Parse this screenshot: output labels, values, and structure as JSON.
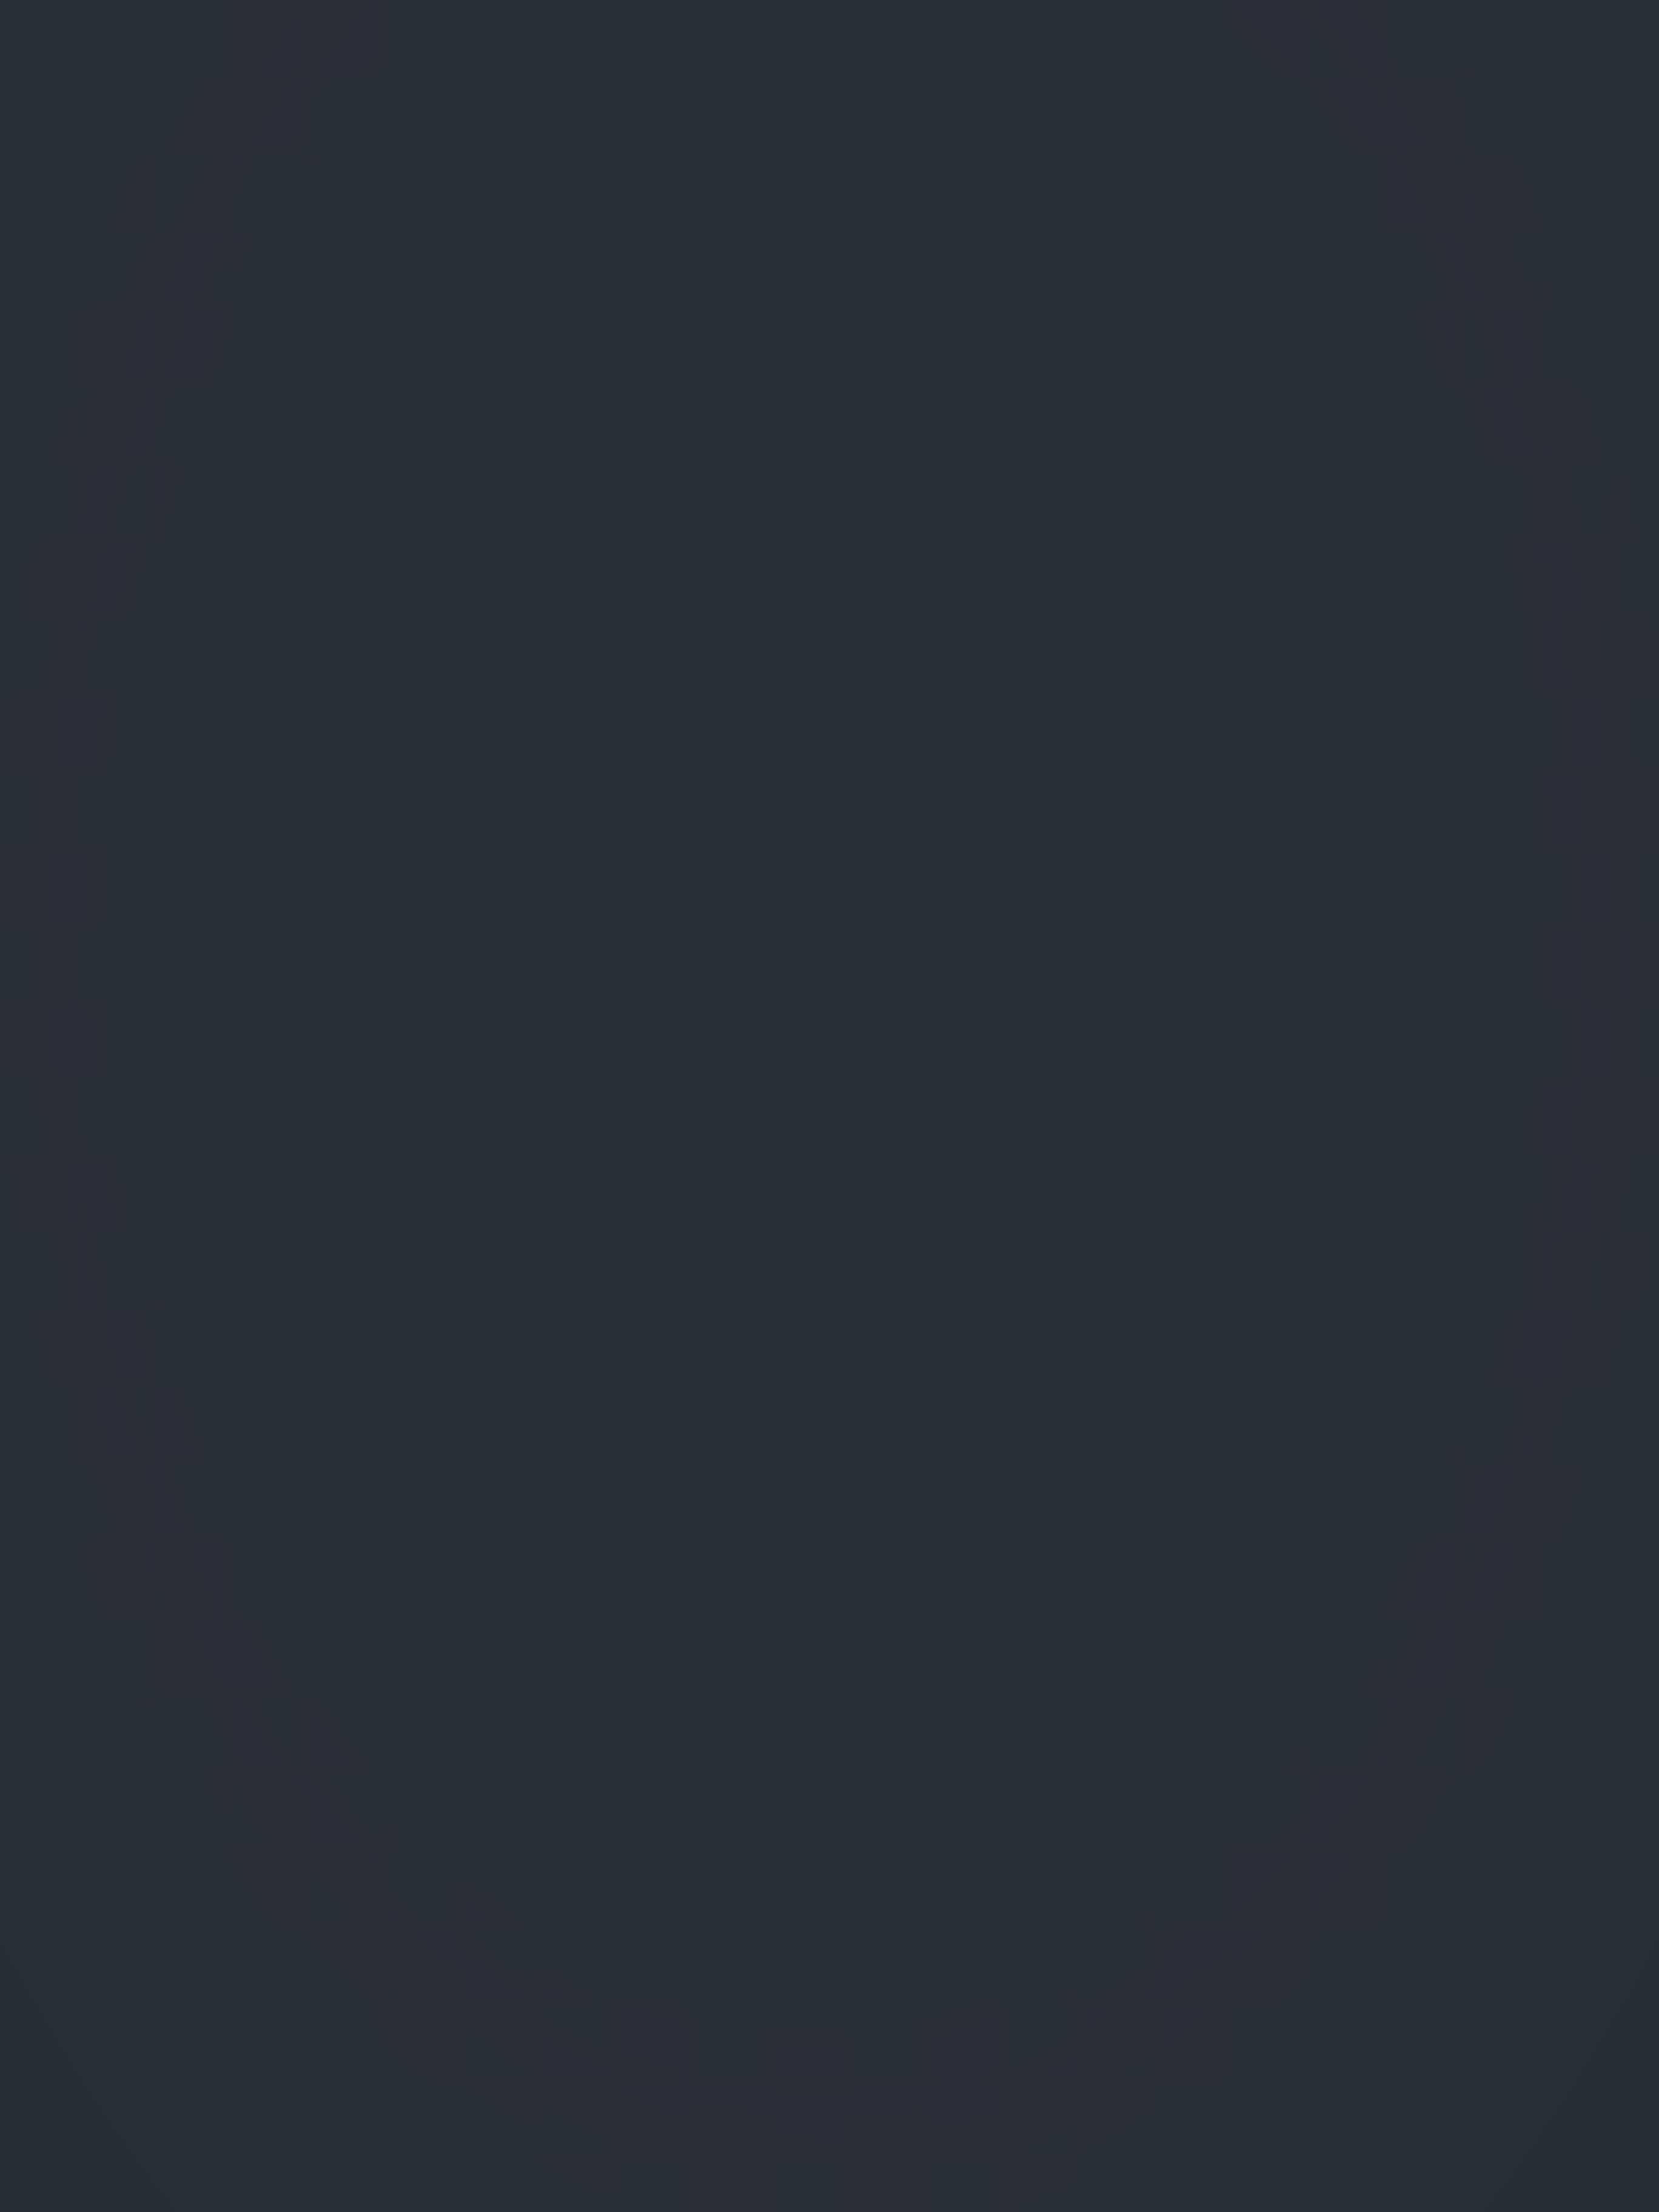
{
  "title": "宗 地 图",
  "unit_note": "单位: m.m²",
  "header": {
    "parcel_code_label": "宗地代码:",
    "parcel_code": "430281105212JC00010",
    "rights_holder_label": "土地权利人:",
    "rights_holder": "唐征",
    "sheet_no_label": "所在图幅号:",
    "sheet_no": "3068.00-458.50",
    "parcel_area_label": "宗地面积:",
    "parcel_area": "96.42"
  },
  "map": {
    "north_label": "北",
    "field_symbol": "↓",
    "building_top": "砖2",
    "building_right": "砖3",
    "building_bottom": "砖3",
    "cement": "水泥",
    "village": "王仙镇司徒村新屋组",
    "parcel": {
      "owner": "唐征",
      "code": "JC00010",
      "subcode": "072",
      "area": "96.42",
      "points": [
        {
          "name": "J1"
        },
        {
          "name": "J2"
        },
        {
          "name": "J3"
        },
        {
          "name": "J4"
        }
      ],
      "dim_top": "20.35",
      "dim_bottom": "20.30",
      "dim_left": "4.75",
      "dim_right": "4.75"
    },
    "road_markers": [
      "95",
      "94",
      "93",
      "92",
      "91",
      "90"
    ]
  },
  "stamp": {
    "line1": "醴陵市国土资源测绘院",
    "line2": "成果资料专用章",
    "grade_label": "证书等级:",
    "grade": "乙 级",
    "certno_label": "证书编号:",
    "certno": "4311522",
    "issuer_label": "发证机关:",
    "issuer": "湖南省国土资源厅"
  },
  "side_label": "醴陵市国土资源局",
  "footer": {
    "survey_note": "2017年解析法测绘界址点",
    "draw_date_label": "制图日期:",
    "draw_date": "2017年8月19日",
    "review_date_label": "审核日期:",
    "review_date": "2017年8月19日",
    "scale": "1:300",
    "drafter_label": "制图者:",
    "reviewer_label": "审核者:"
  },
  "bleedthrough": [
    "测绘成果表",
    "宗地代码 430281105212JC00010",
    "宗地名称",
    "宗地面积(平方米)",
    "土地面积(平方米)",
    "界址点坐标"
  ],
  "colors": {
    "ink_red": "#a0483a",
    "stamp_red": "#c4574d",
    "line_black": "#303438",
    "paper": "#c6ccc2"
  }
}
